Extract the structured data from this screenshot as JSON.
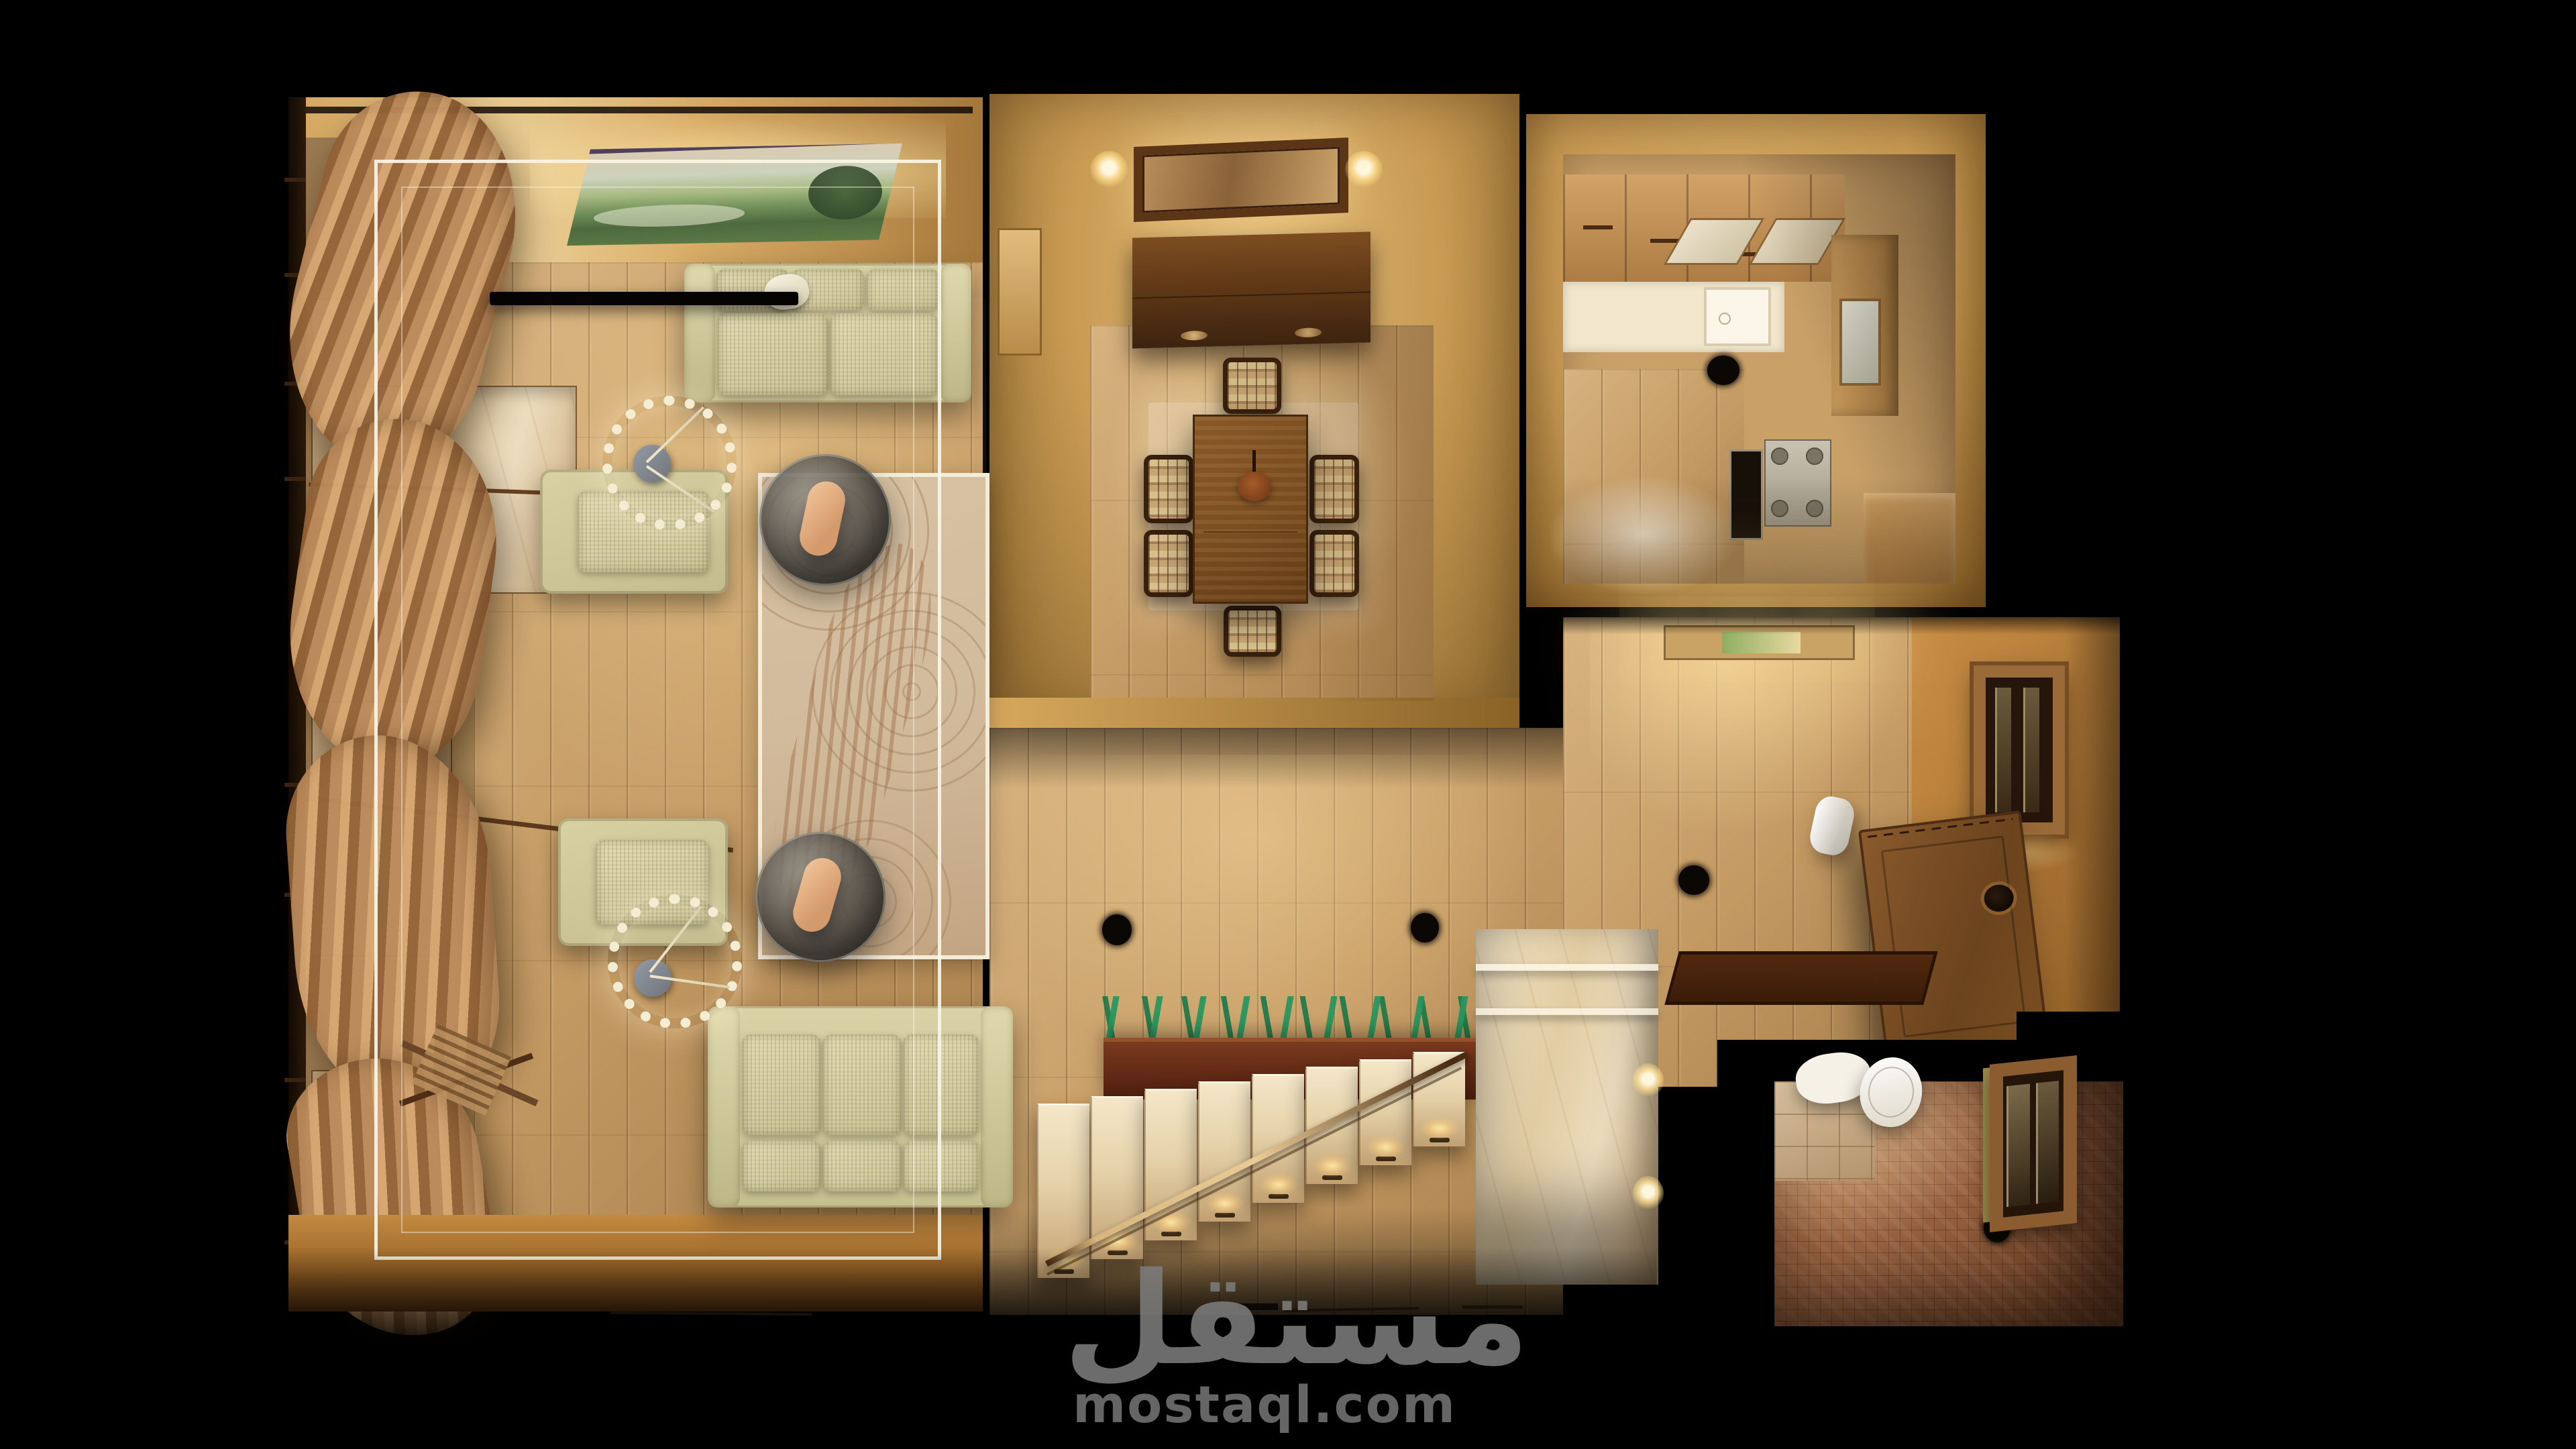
{
  "watermark": {
    "arabic": "مستقل",
    "latin": "mostaql.com"
  },
  "palette": {
    "background": "#000000",
    "wall_amber": "#c89a52",
    "wall_bright": "#ecd199",
    "wood_floor": "#c49a63",
    "wood_light": "#d7b37f",
    "sofa_cream": "#d9d2a6",
    "dark_wood": "#5c3516",
    "table_wood": "#7c4e20",
    "marble": "#ecdcbd",
    "rug_base": "#d2bb9c",
    "rug_swirl": "#8a5f3e",
    "curtain": "#bd8c5c",
    "mosaic_tile": "#9a6342",
    "door_wood": "#7a4e22",
    "glass_gray": "#6e6a62",
    "cove_white": "#f7f2e0",
    "glow_warm": "#ffe3a6",
    "watermark_gray": "#7c7c7c"
  },
  "scene": {
    "view": "top-down-3d-floorplan-render",
    "living_room": {
      "furniture": [
        "curtain-wall",
        "curtain-rods",
        "landscape-painting",
        "ceiling-cove-outline",
        "wall-mounted-tv",
        "marble-console",
        "three-seat-sofa-top",
        "three-seat-sofa-bottom",
        "armchair",
        "armchair",
        "round-glass-coffee-table",
        "round-glass-coffee-table",
        "ring-chandelier",
        "ring-chandelier",
        "patterned-rug",
        "folded-lounge-chair"
      ]
    },
    "dining_room": {
      "furniture": [
        "wall-mirror",
        "wall-sconce",
        "wall-sconce",
        "sideboard",
        "dining-table",
        "table-centerpiece",
        "area-rug",
        "dining-chair",
        "dining-chair",
        "dining-chair",
        "dining-chair",
        "dining-chair",
        "dining-chair"
      ]
    },
    "kitchen": {
      "furniture": [
        "upper-cabinets",
        "glass-cabinet-doors",
        "counter",
        "sink",
        "cooktop-hole-downlight",
        "stove",
        "oven",
        "tall-cabinet",
        "base-cabinet"
      ]
    },
    "entry_hall": {
      "furniture": [
        "ceiling-light-panel",
        "entrance-door",
        "door-knob",
        "wall-niche-window",
        "doormat",
        "cylinder-bin",
        "floor-downlight",
        "floor-downlight",
        "floor-downlight"
      ]
    },
    "staircase": {
      "furniture": [
        "marble-steps",
        "handrail",
        "step-lights",
        "planter-box",
        "plants",
        "marble-landing",
        "landing-wall-lights"
      ]
    },
    "bathroom": {
      "furniture": [
        "toilet",
        "window",
        "mosaic-tile-walls",
        "mosaic-tile-floor",
        "floor-downlight"
      ]
    }
  }
}
